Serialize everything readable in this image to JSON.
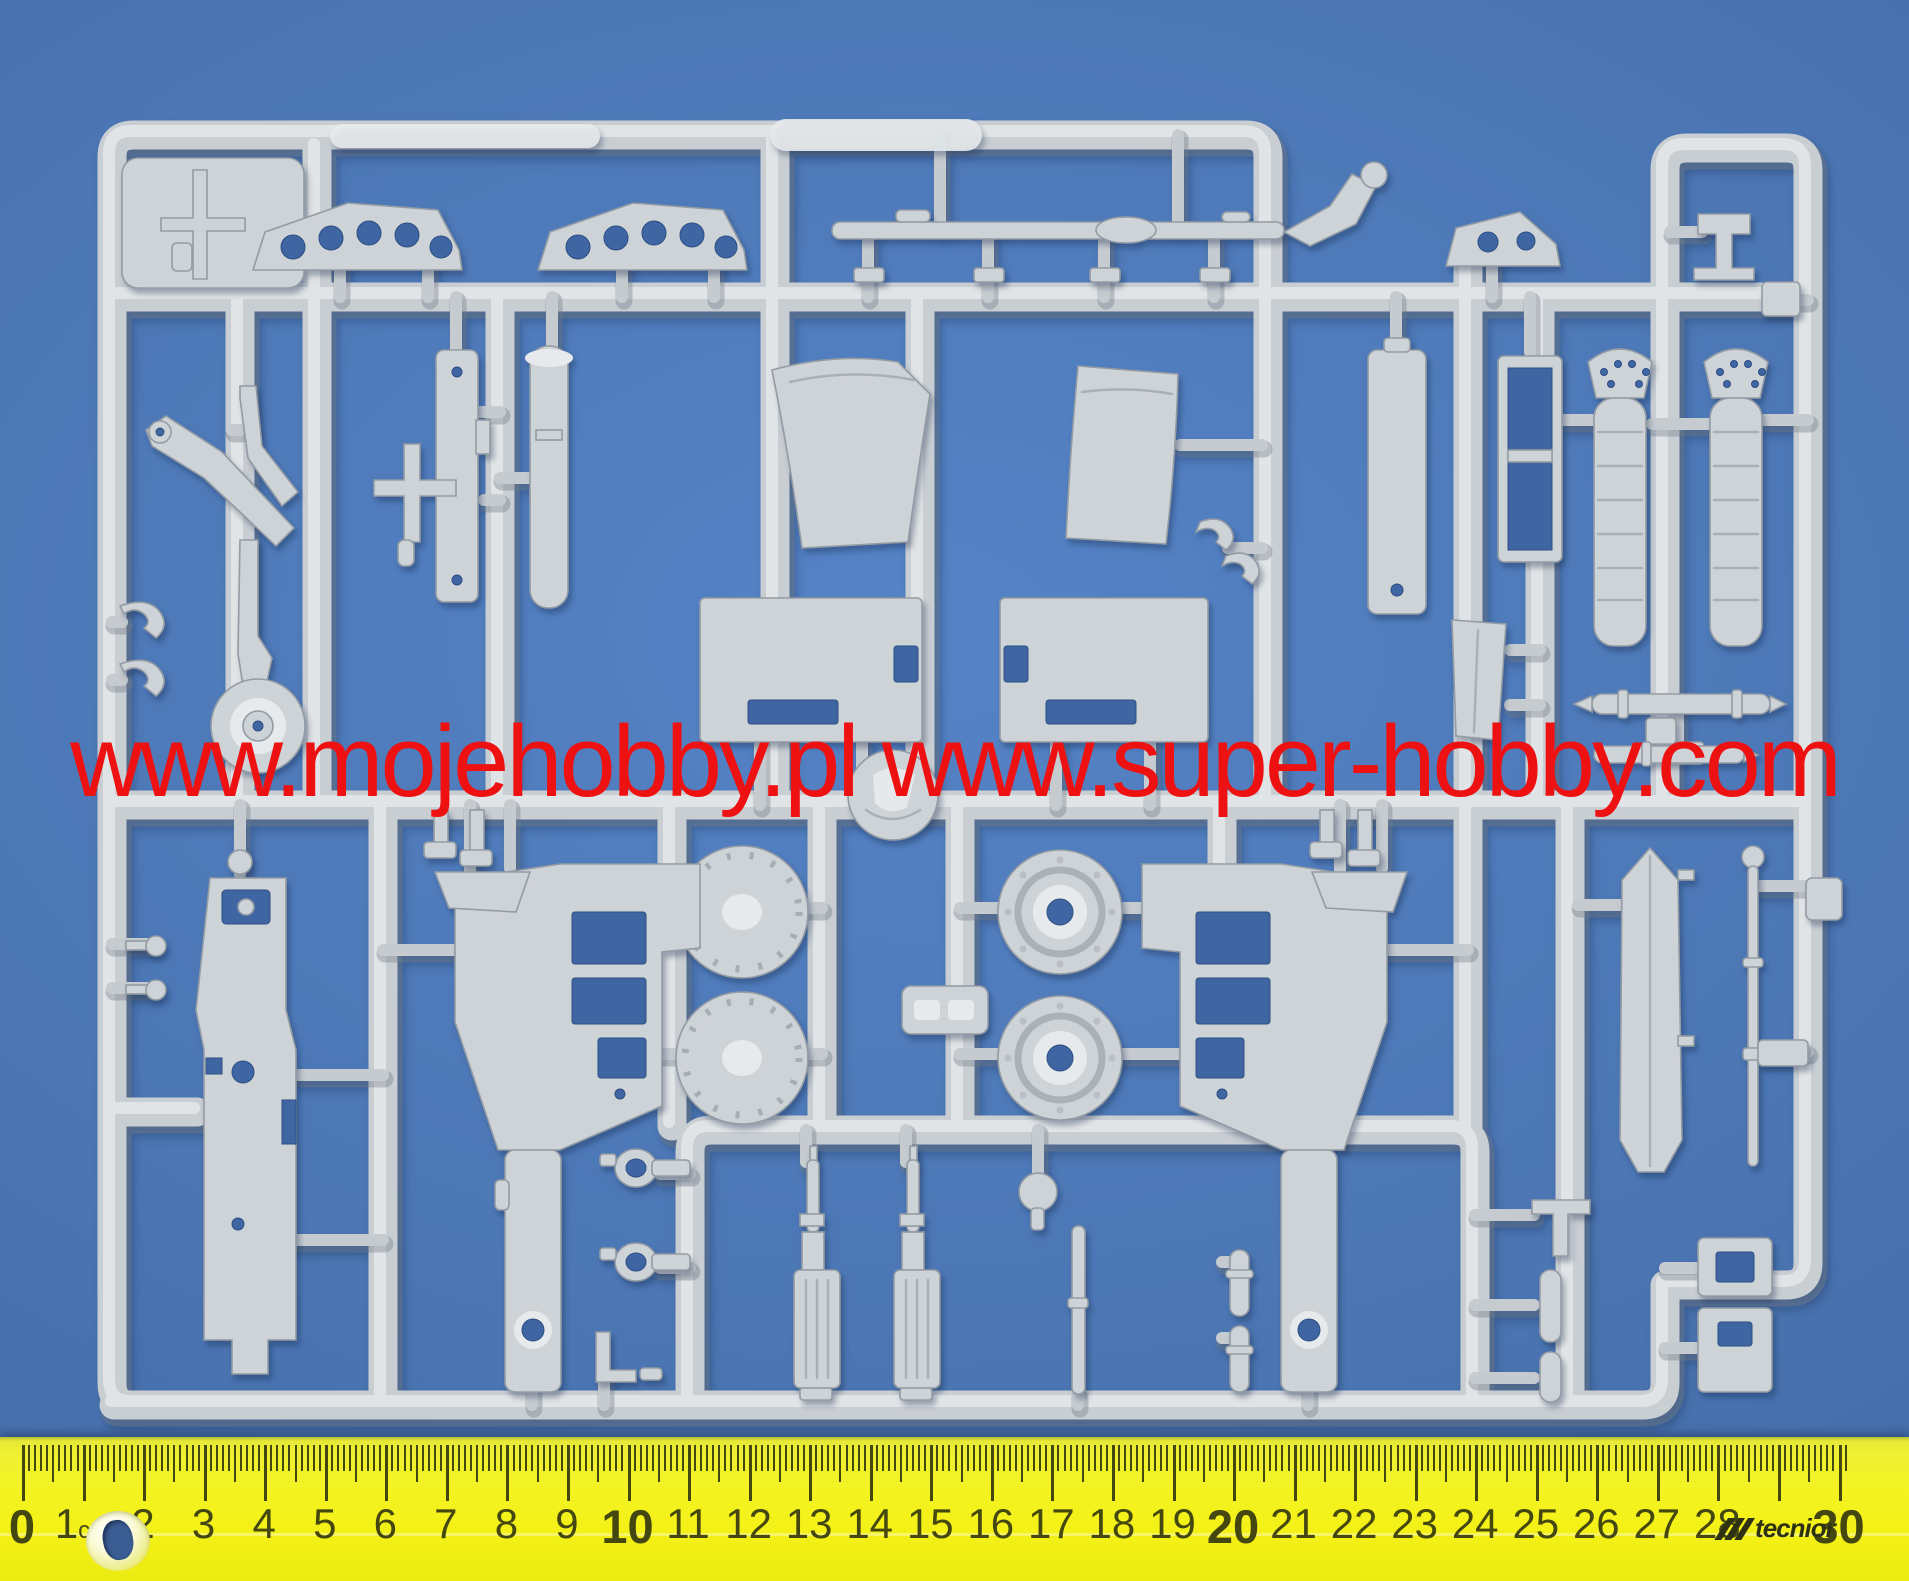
{
  "scene": {
    "description": "Photograph of a light grey injection-moulded plastic sprue of aircraft model kit parts lying on a blue mat, with a red shop watermark across the middle and a yellow 30 cm ruler along the bottom edge",
    "colors": {
      "background": "#4a74b1",
      "background_light": "#5583c6",
      "background_dark": "#3c62a0",
      "plastic": "#ced3d7",
      "plastic_highlight": "#e7eaec",
      "plastic_shadow": "#939ba4",
      "runner_grey": "#c9ced3",
      "through_hole_blue": "#3f66a3",
      "watermark_red": "#ee1111",
      "ruler_yellow": "#f3f21d",
      "ruler_markings": "#44470f",
      "hole_mat_blue": "#3a5d93"
    },
    "watermark": {
      "text": "www.mojehobby.pl www.super-hobby.com",
      "color": "#ee1111"
    },
    "ruler": {
      "numbers": [
        "0",
        "1",
        "2",
        "3",
        "4",
        "5",
        "6",
        "7",
        "8",
        "9",
        "10",
        "11",
        "12",
        "13",
        "14",
        "15",
        "16",
        "17",
        "18",
        "19",
        "20",
        "21",
        "22",
        "23",
        "24",
        "25",
        "26",
        "27",
        "28",
        "",
        "30"
      ],
      "unit_label_index": 1,
      "unit_suffix": "cm",
      "brand": "tecnior",
      "brand_at": 29,
      "ticks_per_cm": 10,
      "length_cm": 30
    },
    "sprue": {
      "material": "light grey polystyrene",
      "parts": [
        "sprue-frame",
        "corner-plate",
        "machine-gun-small",
        "wing-spar-a",
        "wing-spar-b",
        "wing-spar-c",
        "control-linkage-rod",
        "instrument-board",
        "support-cylinder",
        "landing-gear-retract-strut",
        "cross-lever",
        "seat-back-panel-left",
        "seat-back-panel-right",
        "clevis-hooks",
        "tall-support-bar",
        "framed-access-panel",
        "exhaust-stack-left",
        "exhaust-stack-right",
        "hook-pair",
        "left-knobs",
        "bulkhead-plate-left",
        "bulkhead-plate-right",
        "tail-wheel",
        "gun-breech-column",
        "clear-style-disc",
        "wheel-disc-smooth-upper",
        "wheel-disc-smooth-lower",
        "wheel-hub-upper",
        "wheel-hub-lower",
        "part-number-tab",
        "cockpit-tub-left",
        "cockpit-tub-right",
        "wedge-chip-left",
        "wedge-chip-right",
        "rudder-pedals",
        "fin-blade",
        "torpedo-bomb-upper",
        "torpedo-bomb-lower",
        "fuel-tank",
        "antenna-rod",
        "right-edge-pads",
        "ring-lever-upper",
        "ring-lever-lower",
        "l-pin",
        "machine-gun-body-left",
        "machine-gun-body-right",
        "ball-lever",
        "push-rod",
        "rocket-pair",
        "bracket-and-bombs",
        "right-lower-plates",
        "gun-mount-small",
        "moulded-label-bumps"
      ]
    }
  }
}
